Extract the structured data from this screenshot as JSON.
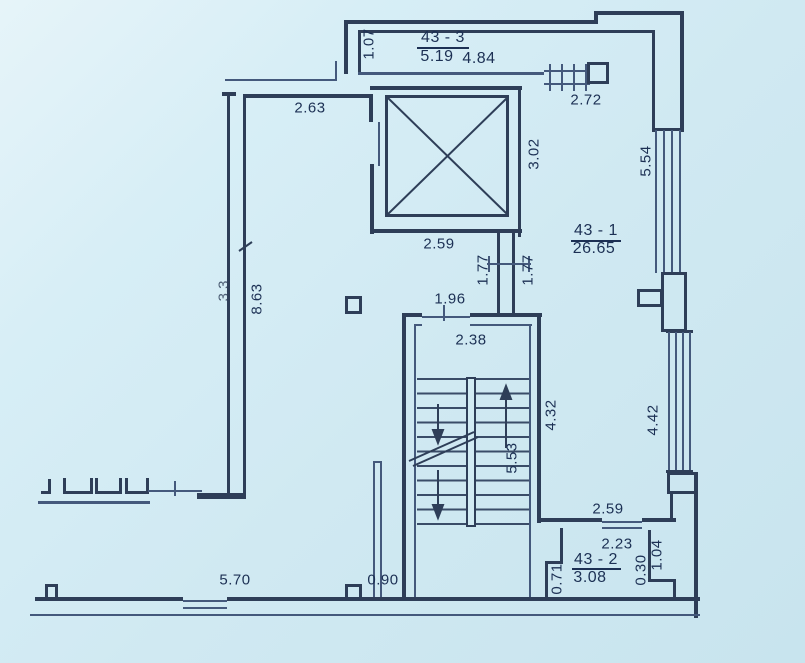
{
  "drawing": {
    "type": "floor-plan",
    "colors": {
      "background": "#d2ebf3",
      "line": "#2e3e58",
      "text": "#1c3054"
    }
  },
  "rooms": {
    "r3": {
      "id": "43 - 3",
      "area": "5.19",
      "area2": "4.84"
    },
    "r1": {
      "id": "43 - 1",
      "area": "26.65"
    },
    "r2": {
      "id": "43 - 2",
      "area": "3.08"
    }
  },
  "dims": {
    "d107": "1.07",
    "d263": "2.63",
    "d272": "2.72",
    "d302": "3.02",
    "d554": "5.54",
    "d259top": "2.59",
    "d177L": "1.77",
    "d177R": "1.77",
    "d863": "8.63",
    "dhidden": "3.3",
    "d196": "1.96",
    "d238": "2.38",
    "d432": "4.32",
    "d553": "5.53",
    "d442": "4.42",
    "d259low": "2.59",
    "d223": "2.23",
    "d030": "0.30",
    "d104": "1.04",
    "d071": "0.71",
    "d570": "5.70",
    "d090": "0.90"
  }
}
